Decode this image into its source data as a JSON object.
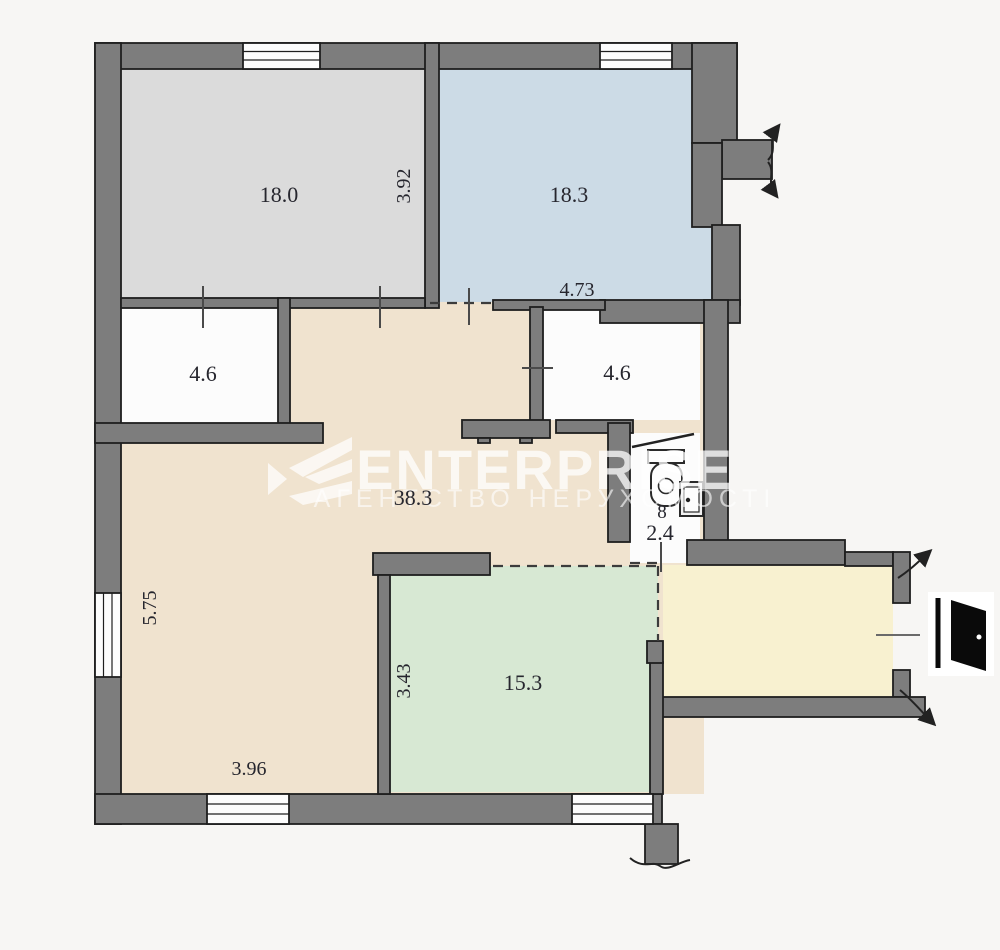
{
  "watermark": {
    "brand": "ENTERPRISE",
    "subtitle": "АГЕНТСТВО НЕРУХОМОСТІ",
    "logo_icon": "chevron-e-logo"
  },
  "rooms": {
    "top_left": {
      "kind": "room",
      "area": "18.0"
    },
    "top_right": {
      "kind": "room",
      "area": "18.3"
    },
    "closet_left": {
      "kind": "storage",
      "area": "4.6"
    },
    "closet_right": {
      "kind": "storage",
      "area": "4.6"
    },
    "hall": {
      "kind": "hall",
      "area": "38.3"
    },
    "green_room": {
      "kind": "room",
      "area": "15.3"
    },
    "wc": {
      "kind": "bathroom",
      "number": "8",
      "area": "2.4",
      "fixtures": [
        "toilet-icon",
        "sink-icon"
      ]
    },
    "entry": {
      "kind": "entry-corridor",
      "door": "entrance-door-icon"
    }
  },
  "dimensions": {
    "top_left_height": "3.92",
    "top_right_width": "4.73",
    "hall_height": "5.75",
    "hall_width": "3.96",
    "green_height": "3.43"
  },
  "colors": {
    "background": "#f7f6f4",
    "wall": "#7d7d7d",
    "wall_outline": "#1e1e1e",
    "room_gray": "#dbdbdb",
    "room_blue": "#ccdbe6",
    "hall_beige": "#f0e3cf",
    "room_green": "#d7e8d3",
    "entry_yellow": "#f8f1d0",
    "room_white": "#fcfcfc",
    "label_text": "#26262e"
  }
}
